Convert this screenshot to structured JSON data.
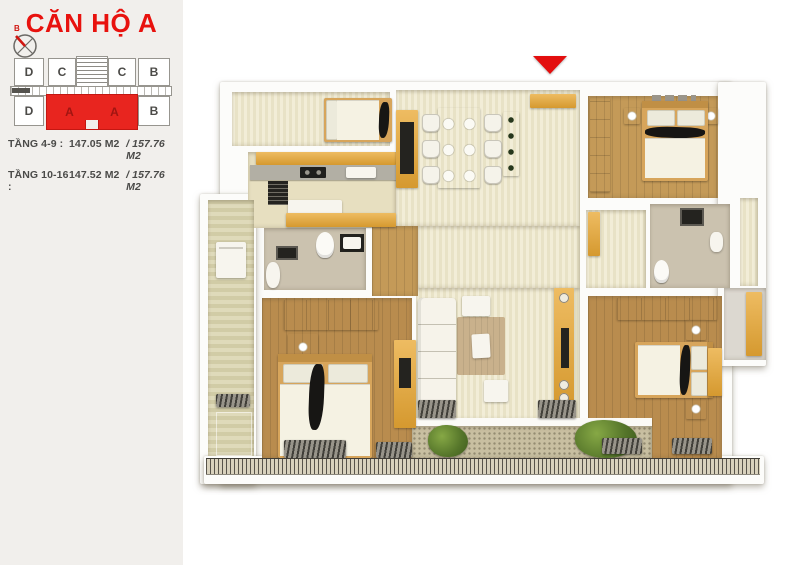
{
  "panel": {
    "title": "CĂN HỘ A",
    "compass": {
      "north_label": "B"
    },
    "diagram": {
      "units": [
        {
          "label": "D"
        },
        {
          "label": "C"
        },
        {
          "label": "C"
        },
        {
          "label": "B"
        },
        {
          "label": "D"
        },
        {
          "label": "A"
        },
        {
          "label": "A"
        },
        {
          "label": "B"
        }
      ],
      "highlighted_unit": "A",
      "highlight_color": "#e8251f"
    },
    "areas": [
      {
        "label": "TẦNG 4-9 :",
        "area": "147.05 M2",
        "total": "/ 157.76 M2"
      },
      {
        "label": "TẦNG 10-16 :",
        "area": "147.52 M2",
        "total": "/ 157.76 M2"
      }
    ]
  },
  "floor_plan": {
    "entrance_marker_color": "#e30e0e",
    "palette": {
      "wall": "#fcfcfa",
      "cream_floor": "#ede7ca",
      "wood_floor": "#c49a58",
      "furniture_wood": "#e0a647",
      "bath_tile": "#cbc2af",
      "utility_tile": "#d8d2ab",
      "pebble": "#c8bfa1",
      "plant_green": "#5f7f2d",
      "accent_black": "#171614"
    }
  }
}
